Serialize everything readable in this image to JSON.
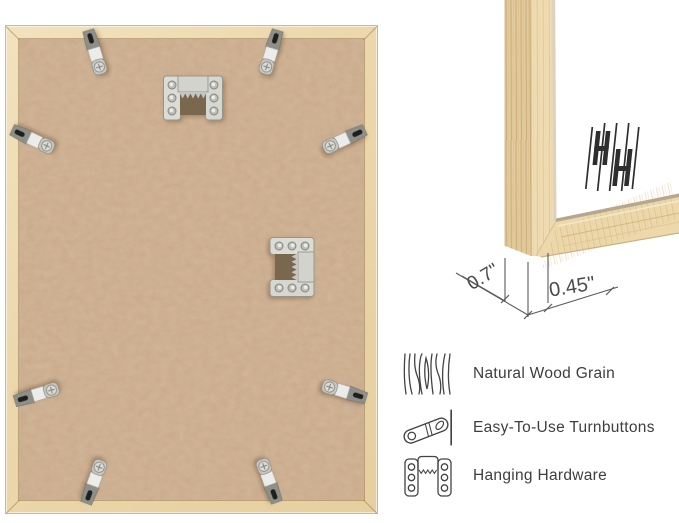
{
  "image": {
    "background": "#ffffff",
    "subject": "Back view of a natural wood picture frame with corner close-up and feature callouts"
  },
  "frame_back": {
    "wood_color": "#ecd8ad",
    "backing_color": "#c7a686",
    "turnbutton_count": 8,
    "sawtooth_hanger_count": 2
  },
  "corner_detail": {
    "depth_label": "0.7\"",
    "face_width_label": "0.45\"",
    "brand_logo_icon": "double-h-logo",
    "wood_color": "#eedcb2",
    "art_color": "#ffffff"
  },
  "features": [
    {
      "icon": "wood-grain-icon",
      "label": "Natural Wood Grain"
    },
    {
      "icon": "turnbutton-icon",
      "label": "Easy-To-Use Turnbuttons"
    },
    {
      "icon": "hanging-hardware-icon",
      "label": "Hanging Hardware"
    }
  ],
  "colors": {
    "metal_hardware": "#d6d6d1",
    "feature_text": "#3e3e3e",
    "dimension_text": "#4a4a4a",
    "icon_stroke": "#434343"
  }
}
